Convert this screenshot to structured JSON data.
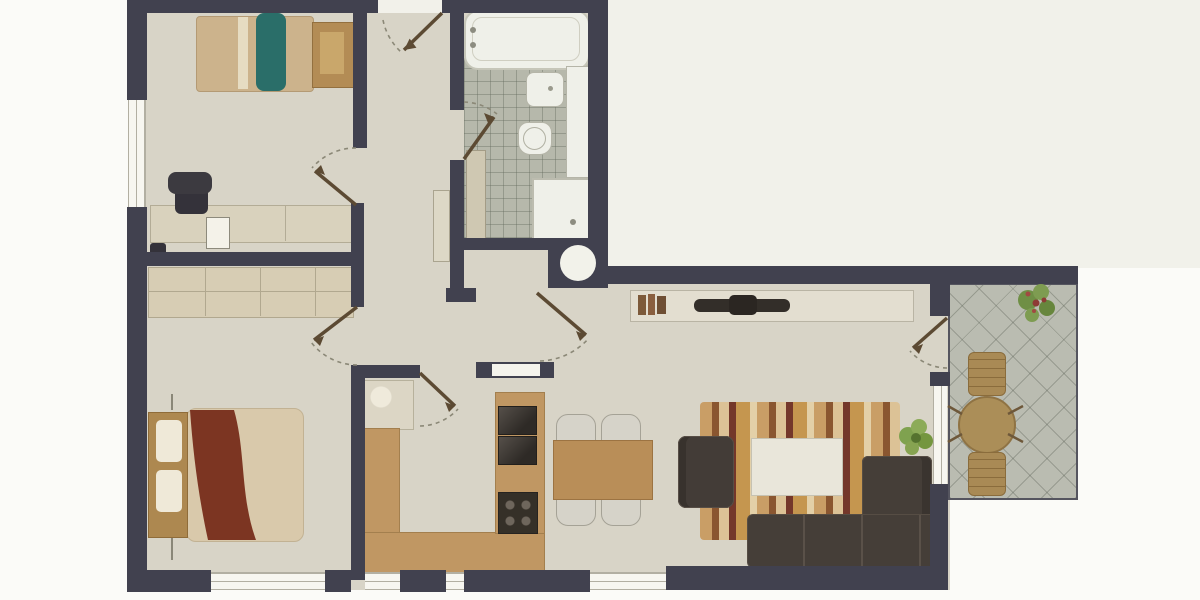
{
  "app": {
    "type": "architectural-floor-plan",
    "description": "top-down color floor plan of a two-bedroom apartment with balcony",
    "visible_text": "none"
  },
  "palette": {
    "wall": "#41414f",
    "floor": "#d8d4c7",
    "outside": "#f1f1ea",
    "page_background": "#fbfbf8",
    "kitchen_counter": "#c09763",
    "bathroom_tile": "#b6b8ab",
    "balcony_tile": "#babcb1",
    "fixture_white": "#eff0e9",
    "sofa_dark": "#453e38",
    "bed_blanket_red": "#7c3522",
    "bed_duvet": "#d9c9ab",
    "headboard_wood": "#ad8850",
    "accent_teal": "#2a6e69",
    "dining_table_wood": "#b98e58",
    "rug_wood_tones": [
      "#c99e66",
      "#8a5630",
      "#dcc296",
      "#74372a",
      "#c5964f",
      "#e3d0a8"
    ],
    "plant_green": "#7fa24f",
    "door_arc_gray": "#8b8877",
    "door_leaf_brown": "#5c4a33"
  },
  "rooms": [
    {
      "name": "small-bedroom",
      "position": "top-left",
      "furniture": [
        "single-bed",
        "teal-blanket",
        "wood-desk",
        "office-chair",
        "desk-counter",
        "paper-sheet",
        "table-lamp"
      ]
    },
    {
      "name": "master-bedroom",
      "position": "bottom-left",
      "furniture": [
        "wardrobe",
        "double-bed",
        "wood-headboard",
        "pillows",
        "red-blanket"
      ]
    },
    {
      "name": "bathroom",
      "position": "top-center",
      "furniture": [
        "bathtub",
        "bidet",
        "toilet",
        "shower",
        "tall-cabinet",
        "washing-machine-circle",
        "tiled-floor"
      ]
    },
    {
      "name": "hall",
      "position": "center",
      "furniture": [
        "radiator"
      ]
    },
    {
      "name": "kitchen",
      "position": "bottom-center",
      "furniture": [
        "u-shaped-counter",
        "sink-counter",
        "oven-stack",
        "stove-4-burners",
        "wall-hatch"
      ]
    },
    {
      "name": "dining-area",
      "position": "bottom-center-right",
      "furniture": [
        "dining-table",
        "chair",
        "chair",
        "chair",
        "chair"
      ]
    },
    {
      "name": "living-room",
      "position": "right",
      "furniture": [
        "sideboard",
        "books",
        "tv-console",
        "striped-rug",
        "coffee-table",
        "armchair",
        "l-shaped-sofa",
        "potted-plant"
      ]
    },
    {
      "name": "balcony",
      "position": "far-right",
      "furniture": [
        "round-table",
        "lounge-chair",
        "lounge-chair",
        "flower-plant",
        "diagonal-tiles"
      ]
    }
  ],
  "doors": [
    {
      "name": "entrance-door",
      "swing": "into-hall-with-arrow"
    },
    {
      "name": "small-bedroom-door",
      "swing": "into-room"
    },
    {
      "name": "master-bedroom-door",
      "swing": "into-room"
    },
    {
      "name": "bathroom-door",
      "swing": "into-bathroom"
    },
    {
      "name": "kitchen-door",
      "swing": "into-kitchen"
    },
    {
      "name": "living-room-door",
      "swing": "into-living-room"
    },
    {
      "name": "balcony-door",
      "swing": "into-living-room"
    }
  ],
  "windows": [
    {
      "name": "left-wall-window",
      "wall": "west"
    },
    {
      "name": "bottom-window-bedroom",
      "wall": "south"
    },
    {
      "name": "bottom-window-kitchen",
      "wall": "south"
    },
    {
      "name": "bottom-window-small",
      "wall": "south"
    },
    {
      "name": "bottom-window-dining",
      "wall": "south"
    },
    {
      "name": "living-room-side-window",
      "wall": "east-to-balcony"
    }
  ]
}
